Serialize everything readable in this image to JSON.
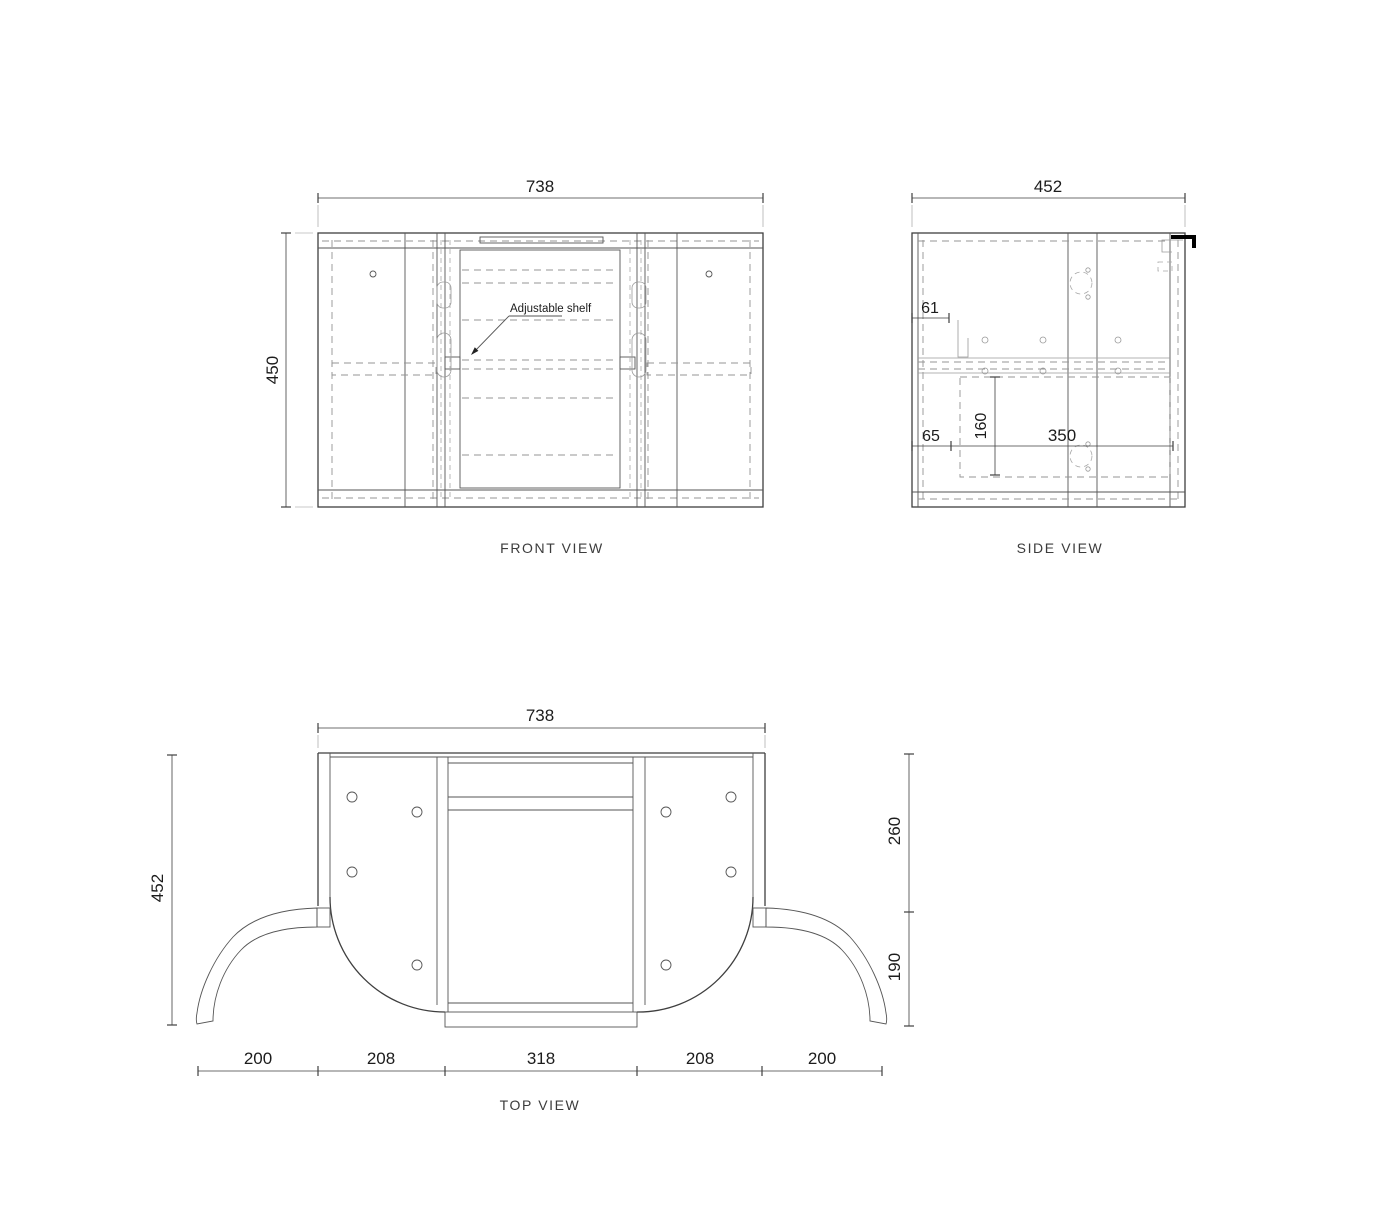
{
  "front_view": {
    "label": "FRONT VIEW",
    "width_dim": "738",
    "height_dim": "450",
    "shelf_note": "Adjustable shelf"
  },
  "side_view": {
    "label": "SIDE VIEW",
    "width_dim": "452",
    "rail_dim": "61",
    "back_offset_dim": "65",
    "shelf_drop_dim": "160",
    "span_dim": "350"
  },
  "top_view": {
    "label": "TOP VIEW",
    "width_dim": "738",
    "depth_dim": "452",
    "right_upper_dim": "260",
    "right_lower_dim": "190",
    "bottom_dims": [
      "200",
      "208",
      "318",
      "208",
      "200"
    ]
  },
  "colors": {
    "line_main": "#3f3f3f",
    "line_hidden": "#949494",
    "bracket_heavy": "#000000",
    "background": "#ffffff"
  }
}
